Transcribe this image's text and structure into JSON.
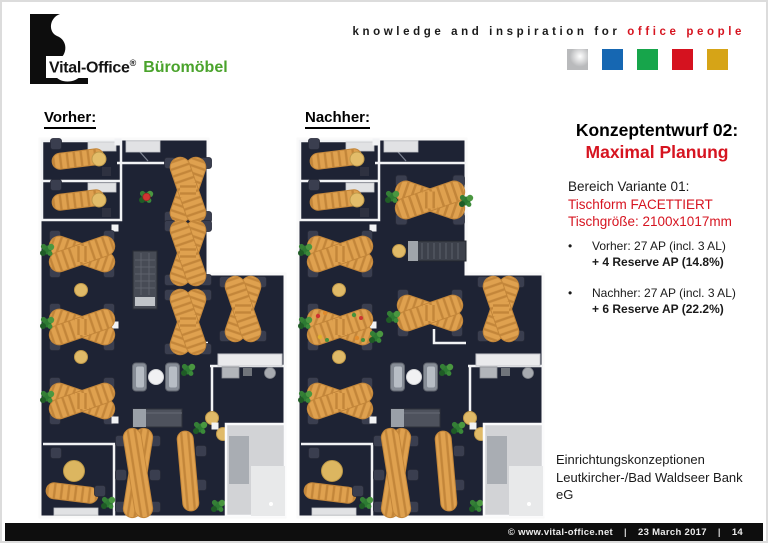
{
  "header": {
    "logo": {
      "brand": "Vital-Office",
      "registered": "®",
      "suffix": "Büromöbel"
    },
    "tagline": {
      "black": "knowledge and inspiration for",
      "red": "office people"
    },
    "brand_squares": [
      {
        "name": "silver",
        "color": "#b9babc"
      },
      {
        "name": "blue",
        "color": "#1667b2"
      },
      {
        "name": "green",
        "color": "#17a54b"
      },
      {
        "name": "red",
        "color": "#d5121f"
      },
      {
        "name": "gold",
        "color": "#d6a417"
      }
    ]
  },
  "plans": {
    "before_label": "Vorher:",
    "after_label": "Nachher:"
  },
  "concept": {
    "title_line1": "Konzeptentwurf 02:",
    "title_line2": "Maximal Planung",
    "variant": {
      "line1": "Bereich Variante 01:",
      "line2": "Tischform FACETTIERT",
      "line3": "Tischgröße: 2100x1017mm"
    },
    "bullets": [
      {
        "line1": "Vorher: 27 AP (incl. 3 AL)",
        "line2": "+ 4 Reserve AP (14.8%)"
      },
      {
        "line1": "Nachher: 27 AP (incl. 3 AL)",
        "line2": "+ 6 Reserve AP (22.2%)"
      }
    ],
    "project": {
      "line1": "Einrichtungskonzeptionen",
      "line2": "Leutkircher-/Bad Waldseer Bank",
      "line3": "eG"
    }
  },
  "footer": {
    "site": "© www.vital-office.net",
    "divider": "|",
    "date": "23 March 2017",
    "page": "14"
  },
  "colors": {
    "accent_red": "#d61420",
    "brand_green": "#4aa32c",
    "floor_navy": "#1e2334",
    "desk_orange": "#dfa14f",
    "desk_stripe": "#c3863a",
    "wall_white": "#f2f3f5"
  }
}
